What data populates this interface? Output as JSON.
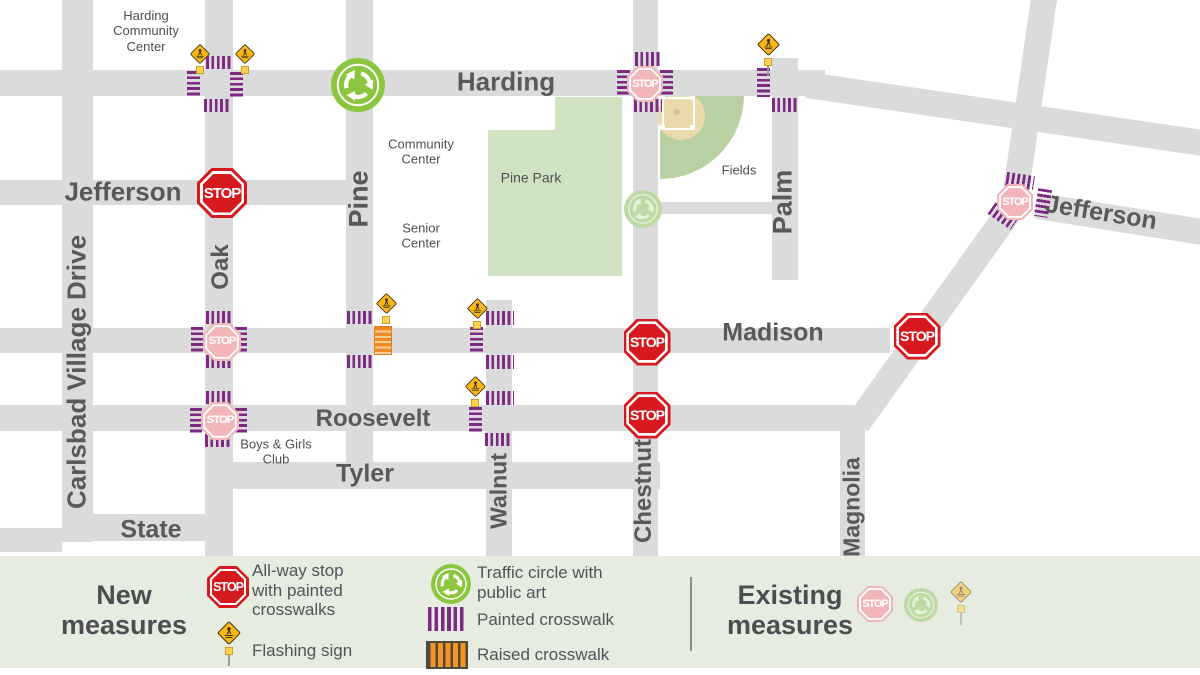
{
  "map": {
    "stop_label": "STOP",
    "colors": {
      "road": "#dbdbdb",
      "crosswalk_purple": "#7c2a83",
      "raised_orange": "#ef8b22",
      "stop_red": "#d6181f",
      "stop_faded": "#f2b6ba",
      "circle_green": "#8cc63e",
      "circle_faded": "#bedaa4",
      "circle_faded_ink": "#e8f1dc",
      "sign_yellow": "#fcb715",
      "park_green": "#cfe3c2",
      "field_green": "#b9d0a3",
      "infield_tan": "#e9d9ab",
      "text_gray": "#58595b",
      "legend_bg": "#e7ece1"
    },
    "roads": [
      {
        "name": "carlsbad-village-drive",
        "x": 62,
        "y": 0,
        "w": 31,
        "h": 542
      },
      {
        "name": "oak",
        "x": 205,
        "y": 0,
        "w": 28,
        "h": 556
      },
      {
        "name": "pine",
        "x": 346,
        "y": 0,
        "w": 27,
        "h": 478
      },
      {
        "name": "walnut",
        "x": 486,
        "y": 300,
        "w": 26,
        "h": 256
      },
      {
        "name": "chestnut",
        "x": 633,
        "y": 0,
        "w": 25,
        "h": 556
      },
      {
        "name": "palm",
        "x": 772,
        "y": 58,
        "w": 26,
        "h": 222
      },
      {
        "name": "magnolia",
        "x": 840,
        "y": 420,
        "w": 25,
        "h": 136
      },
      {
        "name": "harding",
        "x": 0,
        "y": 70,
        "w": 825,
        "h": 26
      },
      {
        "name": "jefferson-west",
        "x": 0,
        "y": 180,
        "w": 373,
        "h": 25
      },
      {
        "name": "jefferson-connector",
        "x": 655,
        "y": 202,
        "w": 125,
        "h": 12
      },
      {
        "name": "madison",
        "x": 0,
        "y": 328,
        "w": 890,
        "h": 25
      },
      {
        "name": "roosevelt",
        "x": 0,
        "y": 405,
        "w": 855,
        "h": 26
      },
      {
        "name": "tyler",
        "x": 232,
        "y": 462,
        "w": 428,
        "h": 27
      },
      {
        "name": "state",
        "x": 62,
        "y": 514,
        "w": 171,
        "h": 27
      },
      {
        "name": "state-stub",
        "x": 0,
        "y": 528,
        "w": 62,
        "h": 24
      },
      {
        "name": "diagonal-upper",
        "x": 1016,
        "y": -9,
        "w": 26,
        "h": 222,
        "rot": 8.3
      },
      {
        "name": "diagonal-lower",
        "x": 923,
        "y": 179,
        "w": 26,
        "h": 270,
        "rot": 35.6
      },
      {
        "name": "harding-diagonal",
        "x": 805,
        "y": 101,
        "w": 400,
        "h": 26,
        "rot": 8.35
      },
      {
        "name": "jefferson-east",
        "x": 1035,
        "y": 206,
        "w": 170,
        "h": 26,
        "rot": 9
      }
    ],
    "crosswalks": [
      {
        "x": 206,
        "y": 56,
        "w": 27,
        "h": 13,
        "dir": "h",
        "type": "painted"
      },
      {
        "x": 187,
        "y": 71,
        "w": 13,
        "h": 27,
        "dir": "v",
        "type": "painted"
      },
      {
        "x": 230,
        "y": 72,
        "w": 13,
        "h": 27,
        "dir": "v",
        "type": "painted"
      },
      {
        "x": 204,
        "y": 99,
        "w": 27,
        "h": 13,
        "dir": "h",
        "type": "painted"
      },
      {
        "x": 206,
        "y": 311,
        "w": 27,
        "h": 13,
        "dir": "h",
        "type": "painted"
      },
      {
        "x": 191,
        "y": 327,
        "w": 12,
        "h": 27,
        "dir": "v",
        "type": "painted"
      },
      {
        "x": 235,
        "y": 327,
        "w": 12,
        "h": 27,
        "dir": "v",
        "type": "painted"
      },
      {
        "x": 206,
        "y": 355,
        "w": 27,
        "h": 13,
        "dir": "h",
        "type": "painted"
      },
      {
        "x": 206,
        "y": 391,
        "w": 27,
        "h": 13,
        "dir": "h",
        "type": "painted"
      },
      {
        "x": 190,
        "y": 408,
        "w": 12,
        "h": 27,
        "dir": "v",
        "type": "painted"
      },
      {
        "x": 235,
        "y": 408,
        "w": 12,
        "h": 27,
        "dir": "v",
        "type": "painted"
      },
      {
        "x": 205,
        "y": 434,
        "w": 27,
        "h": 13,
        "dir": "h",
        "type": "painted"
      },
      {
        "x": 635,
        "y": 52,
        "w": 27,
        "h": 14,
        "dir": "h",
        "type": "painted"
      },
      {
        "x": 617,
        "y": 70,
        "w": 13,
        "h": 27,
        "dir": "v",
        "type": "painted"
      },
      {
        "x": 660,
        "y": 70,
        "w": 13,
        "h": 27,
        "dir": "v",
        "type": "painted"
      },
      {
        "x": 634,
        "y": 99,
        "w": 28,
        "h": 13,
        "dir": "h",
        "type": "painted"
      },
      {
        "x": 757,
        "y": 68,
        "w": 13,
        "h": 29,
        "dir": "v",
        "type": "painted"
      },
      {
        "x": 772,
        "y": 98,
        "w": 27,
        "h": 14,
        "dir": "h",
        "type": "painted"
      },
      {
        "x": 347,
        "y": 311,
        "w": 27,
        "h": 13,
        "dir": "h",
        "type": "painted"
      },
      {
        "x": 347,
        "y": 355,
        "w": 27,
        "h": 13,
        "dir": "h",
        "type": "painted"
      },
      {
        "x": 374,
        "y": 326,
        "w": 16,
        "h": 27,
        "dir": "v",
        "type": "raised"
      },
      {
        "x": 486,
        "y": 311,
        "w": 28,
        "h": 14,
        "dir": "h",
        "type": "painted"
      },
      {
        "x": 470,
        "y": 327,
        "w": 13,
        "h": 27,
        "dir": "v",
        "type": "painted"
      },
      {
        "x": 486,
        "y": 355,
        "w": 28,
        "h": 14,
        "dir": "h",
        "type": "painted"
      },
      {
        "x": 486,
        "y": 391,
        "w": 28,
        "h": 14,
        "dir": "h",
        "type": "painted"
      },
      {
        "x": 469,
        "y": 407,
        "w": 13,
        "h": 27,
        "dir": "v",
        "type": "painted"
      },
      {
        "x": 485,
        "y": 433,
        "w": 26,
        "h": 13,
        "dir": "h",
        "type": "painted"
      },
      {
        "x": 1006,
        "y": 174,
        "w": 28,
        "h": 14,
        "dir": "h",
        "type": "painted",
        "rot": 9
      },
      {
        "x": 1036,
        "y": 189,
        "w": 14,
        "h": 28,
        "dir": "v",
        "type": "painted",
        "rot": 9
      },
      {
        "x": 989,
        "y": 209,
        "w": 28,
        "h": 14,
        "dir": "h",
        "type": "painted",
        "rot": 35
      }
    ],
    "stop_signs": [
      {
        "x": 222,
        "y": 193,
        "size": 50,
        "status": "new"
      },
      {
        "x": 647,
        "y": 342,
        "size": 47,
        "status": "new"
      },
      {
        "x": 647,
        "y": 415,
        "size": 47,
        "status": "new"
      },
      {
        "x": 917,
        "y": 336,
        "size": 47,
        "status": "new"
      },
      {
        "x": 222,
        "y": 342,
        "size": 38,
        "status": "existing"
      },
      {
        "x": 220,
        "y": 421,
        "size": 38,
        "status": "existing"
      },
      {
        "x": 645,
        "y": 84,
        "size": 36,
        "status": "existing"
      },
      {
        "x": 1015,
        "y": 202,
        "size": 36,
        "status": "existing"
      }
    ],
    "traffic_circles": [
      {
        "x": 358,
        "y": 85,
        "r": 27,
        "status": "new"
      },
      {
        "x": 643,
        "y": 209,
        "r": 19,
        "status": "existing"
      }
    ],
    "flashing_signs": [
      {
        "x": 200,
        "y": 54,
        "size": 22,
        "pole": 0
      },
      {
        "x": 245,
        "y": 54,
        "size": 22,
        "pole": 0
      },
      {
        "x": 768,
        "y": 44,
        "size": 25,
        "pole": 10
      },
      {
        "x": 386,
        "y": 303,
        "size": 23,
        "pole": 0
      },
      {
        "x": 477,
        "y": 308,
        "size": 23,
        "pole": 0
      },
      {
        "x": 475,
        "y": 386,
        "size": 23,
        "pole": 0
      }
    ],
    "street_labels": [
      {
        "text": "Harding",
        "x": 506,
        "y": 82,
        "size": 26
      },
      {
        "text": "Jefferson",
        "x": 123,
        "y": 192,
        "size": 26
      },
      {
        "text": "Madison",
        "x": 773,
        "y": 333,
        "size": 25
      },
      {
        "text": "Roosevelt",
        "x": 373,
        "y": 419,
        "size": 24
      },
      {
        "text": "Tyler",
        "x": 365,
        "y": 474,
        "size": 25
      },
      {
        "text": "State",
        "x": 151,
        "y": 530,
        "size": 25
      },
      {
        "text": "Jefferson",
        "x": 1101,
        "y": 213,
        "size": 25,
        "rot": 9
      },
      {
        "text": "Carlsbad Village Drive",
        "x": 77,
        "y": 372,
        "size": 26,
        "rot": -90
      },
      {
        "text": "Oak",
        "x": 221,
        "y": 267,
        "size": 24,
        "rot": -90
      },
      {
        "text": "Pine",
        "x": 359,
        "y": 199,
        "size": 27,
        "rot": -90
      },
      {
        "text": "Walnut",
        "x": 499,
        "y": 491,
        "size": 23,
        "rot": -90
      },
      {
        "text": "Chestnut",
        "x": 644,
        "y": 491,
        "size": 24,
        "rot": -90
      },
      {
        "text": "Palm",
        "x": 783,
        "y": 202,
        "size": 27,
        "rot": -90
      },
      {
        "text": "Magnolia",
        "x": 852,
        "y": 507,
        "size": 23,
        "rot": -90
      }
    ],
    "place_labels": [
      {
        "text": "Harding\nCommunity\nCenter",
        "x": 146,
        "y": 31,
        "size": 13
      },
      {
        "text": "Community\nCenter",
        "x": 421,
        "y": 152,
        "size": 13
      },
      {
        "text": "Senior\nCenter",
        "x": 421,
        "y": 236,
        "size": 13
      },
      {
        "text": "Pine Park",
        "x": 531,
        "y": 178,
        "size": 14
      },
      {
        "text": "Fields",
        "x": 739,
        "y": 170,
        "size": 13
      },
      {
        "text": "Boys & Girls\nClub",
        "x": 276,
        "y": 452,
        "size": 13
      }
    ]
  },
  "legend": {
    "new_title": [
      "New",
      "measures"
    ],
    "existing_title": [
      "Existing",
      "measures"
    ],
    "stop_label": [
      "All-way stop",
      "with painted",
      "crosswalks"
    ],
    "flashing_label": "Flashing sign",
    "circle_label": [
      "Traffic circle with",
      "public art"
    ],
    "painted_label": "Painted crosswalk",
    "raised_label": "Raised crosswalk"
  }
}
